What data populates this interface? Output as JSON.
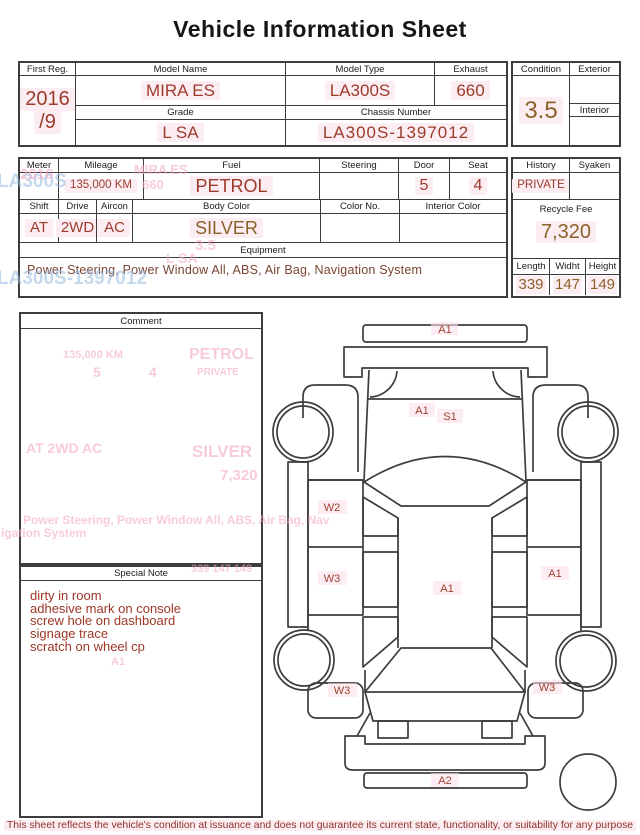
{
  "title": "Vehicle Information Sheet",
  "top": {
    "first_reg_label": "First Reg.",
    "first_reg_line1": "2016",
    "first_reg_line2": "/9",
    "model_name_label": "Model Name",
    "model_name": "MIRA ES",
    "model_type_label": "Model Type",
    "model_type": "LA300S",
    "exhaust_label": "Exhaust",
    "exhaust": "660",
    "grade_label": "Grade",
    "grade": "L SA",
    "chassis_label": "Chassis Number",
    "chassis": "LA300S-1397012"
  },
  "condition": {
    "label": "Condition",
    "value": "3.5",
    "exterior_label": "Exterior",
    "interior_label": "Interior"
  },
  "spec": {
    "meter_label": "Meter",
    "mileage_label": "Mileage",
    "mileage": "135,000 KM",
    "fuel_label": "Fuel",
    "fuel": "PETROL",
    "steering_label": "Steering",
    "door_label": "Door",
    "door": "5",
    "seat_label": "Seat",
    "seat": "4",
    "shift_label": "Shift",
    "shift": "AT",
    "drive_label": "Drive",
    "drive": "2WD",
    "aircon_label": "Aircon",
    "aircon": "AC",
    "body_color_label": "Body Color",
    "body_color": "SILVER",
    "color_no_label": "Color No.",
    "interior_color_label": "Interior Color",
    "equipment_label": "Equipment",
    "equipment": "Power Steering, Power Window  All, ABS, Air Bag, Navigation System"
  },
  "history_panel": {
    "history_label": "History",
    "history": "PRIVATE",
    "syaken_label": "Syaken",
    "recycle_label": "Recycle Fee",
    "recycle": "7,320",
    "length_label": "Length",
    "length": "339",
    "width_label": "Widht",
    "width": "147",
    "height_label": "Height",
    "height": "149"
  },
  "comment": {
    "label": "Comment"
  },
  "special_note": {
    "label": "Special Note",
    "lines": [
      "dirty in room",
      "adhesive mark on console",
      "screw hole on dashboard",
      "signage trace",
      "scratch on wheel cp"
    ]
  },
  "diagram": {
    "labels": {
      "front_bumper": "A1",
      "hood": "A1",
      "hood_s": "S1",
      "door_front_left": "W2",
      "door_rear_left": "W3",
      "roof": "A1",
      "door_rear_right": "A1",
      "wheel_rear_left": "W3",
      "wheel_rear_right": "W3",
      "rear_bumper": "A2"
    }
  },
  "ghosts": {
    "la300s": "LA300S",
    "y2016": "2016",
    "mira": "MIRA ES",
    "g660": "660",
    "chassis": "LA300S-1397012",
    "g35": "3.5",
    "lsa": "L SA",
    "c_mileage": "135,000 KM",
    "c_fuel": "PETROL",
    "c_door": "5",
    "c_seat": "4",
    "c_private": "PRIVATE",
    "c_shift": "AT   2WD   AC",
    "c_color": "SILVER",
    "c_fee": "7,320",
    "c_equip": "Power Steering, Power Window  All, ABS, Air Bag, Nav",
    "c_equip2": "igation System",
    "s_dims": "339   147   149",
    "s_a1": "A1"
  },
  "footer": {
    "text": "This sheet reflects the vehicle's condition at issuance and does not guarantee its current state, functionality, or suitability for any purpose"
  },
  "colors": {
    "value_red": "#9d3b2b",
    "value_brown": "#8c6228",
    "note_red": "#9e3626",
    "ghost_pink": "#f4a8c4",
    "ghost_blue": "#94bae0",
    "border": "#3d3d3d",
    "highlight_pink": "#fcedf3"
  }
}
